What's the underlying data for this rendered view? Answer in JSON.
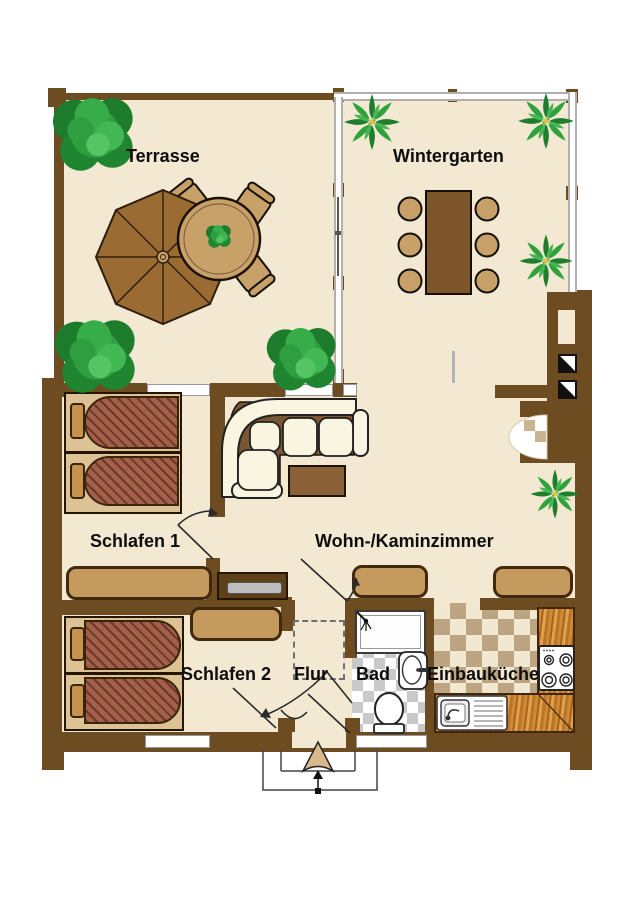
{
  "rooms": {
    "terrasse": {
      "label": "Terrasse"
    },
    "wintergarten": {
      "label": "Wintergarten"
    },
    "schlafen1": {
      "label": "Schlafen 1"
    },
    "wohnzimmer": {
      "label": "Wohn-/Kaminzimmer"
    },
    "schlafen2": {
      "label": "Schlafen 2"
    },
    "flur": {
      "label": "Flur"
    },
    "bad": {
      "label": "Bad"
    },
    "einbaukueche": {
      "label": "Einbauküche"
    }
  },
  "colors": {
    "wall": "#6d4c22",
    "floor": "#f3e9d3",
    "tan": "#c49a5f",
    "chair_tan": "#c8a169",
    "bed_frame": "#dcc294",
    "pillow": "#c6934f",
    "blanket": "#a2604b",
    "sofa_cream": "#faf5e0",
    "sofa_frame": "#7a5733",
    "dining_table": "#7d572b",
    "coffee_table": "#8a6136",
    "umbrella": "#9a6b33",
    "checker_tan": "#bda583",
    "checker_gray": "#c9c9c9",
    "glazing": "#b0b0b0",
    "plant_green": "#2f9e40",
    "label": "#0d0d0d"
  }
}
